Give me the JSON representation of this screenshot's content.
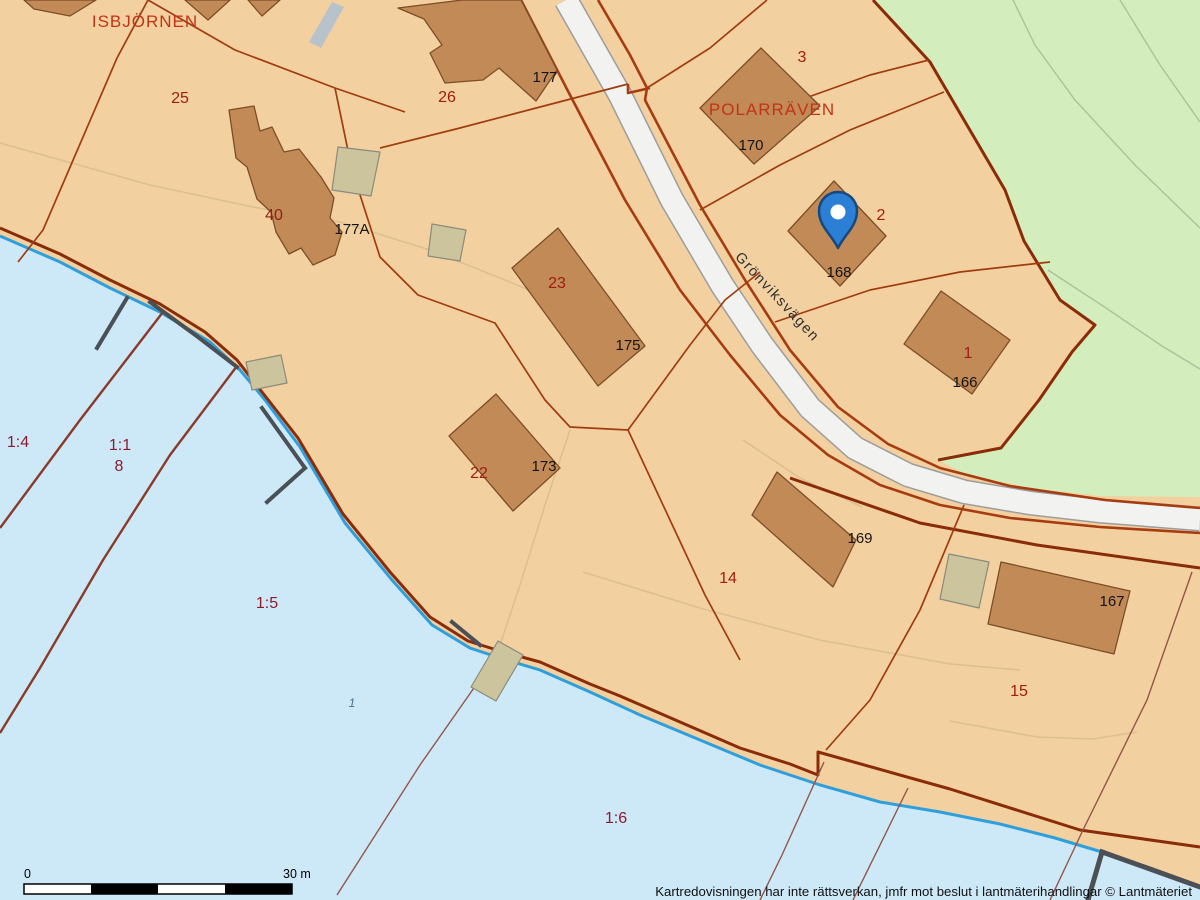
{
  "map": {
    "blocks": {
      "isbjornen": "ISBJÖRNEN",
      "polarraven": "POLARRÄVEN"
    },
    "parcels": {
      "p25": "25",
      "p26": "26",
      "p40": "40",
      "p23": "23",
      "p22": "22",
      "p3": "3",
      "p2": "2",
      "p1": "1",
      "p14": "14",
      "p15": "15"
    },
    "house_numbers": {
      "h177": "177",
      "h177a": "177A",
      "h175": "175",
      "h173": "173",
      "h170": "170",
      "h168": "168",
      "h166": "166",
      "h169": "169",
      "h167": "167"
    },
    "water_parcels": {
      "w14": "1:4",
      "w11": "1:1",
      "w8": "8",
      "w15": "1:5",
      "w16": "1:6",
      "w1": "1"
    },
    "road": {
      "name": "Grönviksvägen"
    },
    "marker": {
      "icon": "location-pin",
      "color": "#2b80d6"
    },
    "scale_bar": {
      "start": "0",
      "end": "30 m"
    },
    "attribution": "Kartredovisningen har inte rättsverkan, jmfr mot beslut i lantmäterihandlingar © Lantmäteriet",
    "colors": {
      "land": "#f3d0a0",
      "water": "#cde9f8",
      "green_area": "#d3eebc",
      "building": "#c28a57",
      "building_outline": "#7d4e26",
      "outbuilding": "#cbc49c",
      "road_fill": "#f2f2f0",
      "road_edge": "#9d9d9d",
      "boundary_thick": "#8a2c08",
      "boundary_thin": "#a03c10",
      "shore_blue": "#2f9fdc",
      "jetty_gray": "#4a5056",
      "label_red": "#c33317",
      "label_dark_red": "#a01d10",
      "label_water_red": "#8e1a2c",
      "label_black": "#141414"
    }
  }
}
